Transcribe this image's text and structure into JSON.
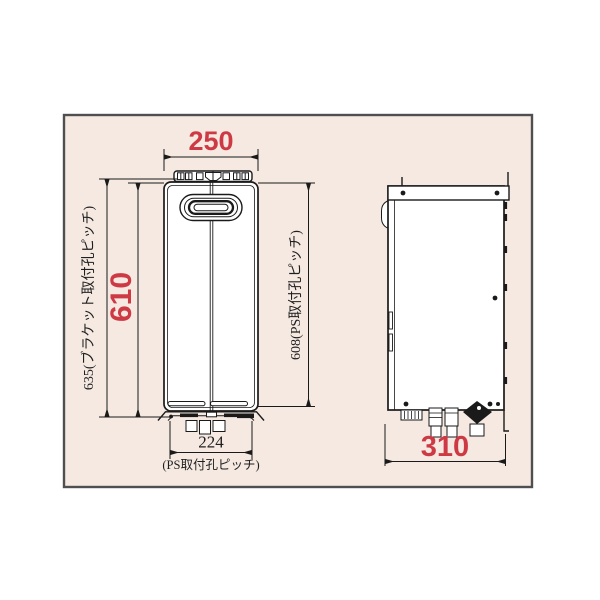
{
  "diagram": {
    "type": "installation-dimension-drawing",
    "views": [
      "front",
      "side"
    ],
    "dims": {
      "front_width": "250",
      "front_height": "610",
      "bracket_pitch": "635(ブラケット取付孔ピッチ)",
      "ps_pitch_right": "608(PS取付孔ピッチ)",
      "bottom_pitch_value": "224",
      "bottom_pitch_caption": "(PS取付孔ピッチ)",
      "side_depth": "310"
    }
  },
  "colors": {
    "accent_red": "#cd3a44",
    "line": "#1a1a1a",
    "panel_bg": "#f5e9e2",
    "panel_border": "#4f4f51"
  }
}
